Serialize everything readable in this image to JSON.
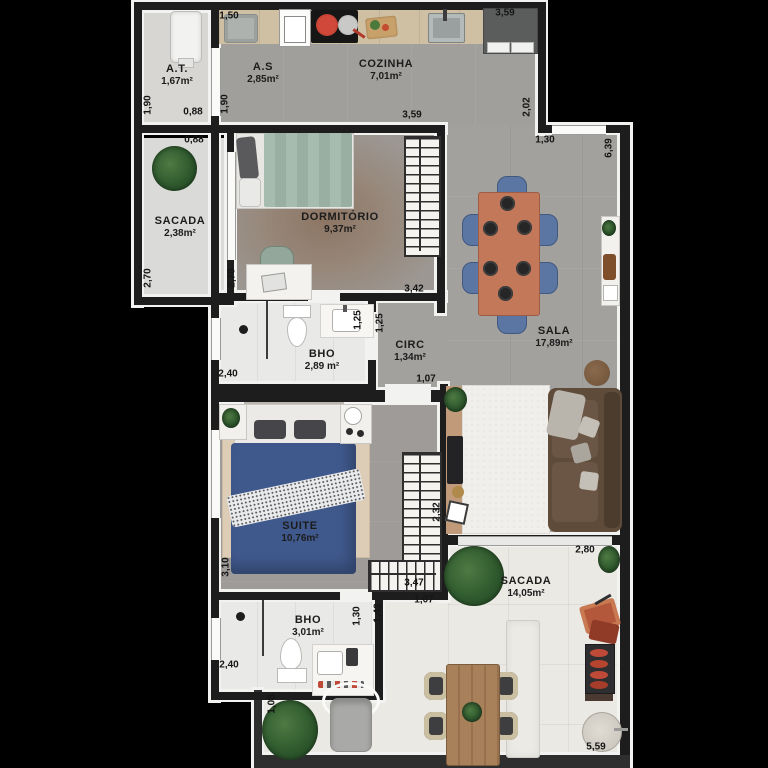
{
  "plan": {
    "rooms": [
      {
        "name": "A.T.",
        "area": "1,67m²"
      },
      {
        "name": "A.S",
        "area": "2,85m²"
      },
      {
        "name": "COZINHA",
        "area": "7,01m²"
      },
      {
        "name": "SACADA",
        "area": "2,38m²"
      },
      {
        "name": "DORMITÓRIO",
        "area": "9,37m²"
      },
      {
        "name": "SALA",
        "area": "17,89m²"
      },
      {
        "name": "BHO",
        "area": "2,89 m²"
      },
      {
        "name": "CIRC",
        "area": "1,34m²"
      },
      {
        "name": "SUITE",
        "area": "10,76m²"
      },
      {
        "name": "BHO",
        "area": "3,01m²"
      },
      {
        "name": "SACADA",
        "area": "14,05m²"
      }
    ],
    "dimensions": [
      "1,50",
      "3,59",
      "1,90",
      "0,88",
      "1,90",
      "0,88",
      "3,59",
      "2,02",
      "1,30",
      "6,39",
      "2,70",
      "2,70",
      "3,42",
      "1,25",
      "1,25",
      "2,40",
      "1,07",
      "3,10",
      "2,32",
      "3,47",
      "2,80",
      "1,30",
      "1,42",
      "1,07",
      "2,40",
      "1,08",
      "5,59"
    ],
    "colors": {
      "wall": "#1d1d1d",
      "floor_interior": "#a09f9c",
      "floor_bath": "#e9e9e7",
      "floor_balcony": "#ebe9e4",
      "counter_wood": "#cfc0a3",
      "dining_table": "#c4785a",
      "chair_blue": "#5b76a3",
      "sofa_brown": "#5e4b3a",
      "bed_suite_blue": "#40598d",
      "bed_dorm_green": "#a6bcae",
      "rug_suite": "#decdb6",
      "outdoor_wood": "#a8805a"
    }
  }
}
